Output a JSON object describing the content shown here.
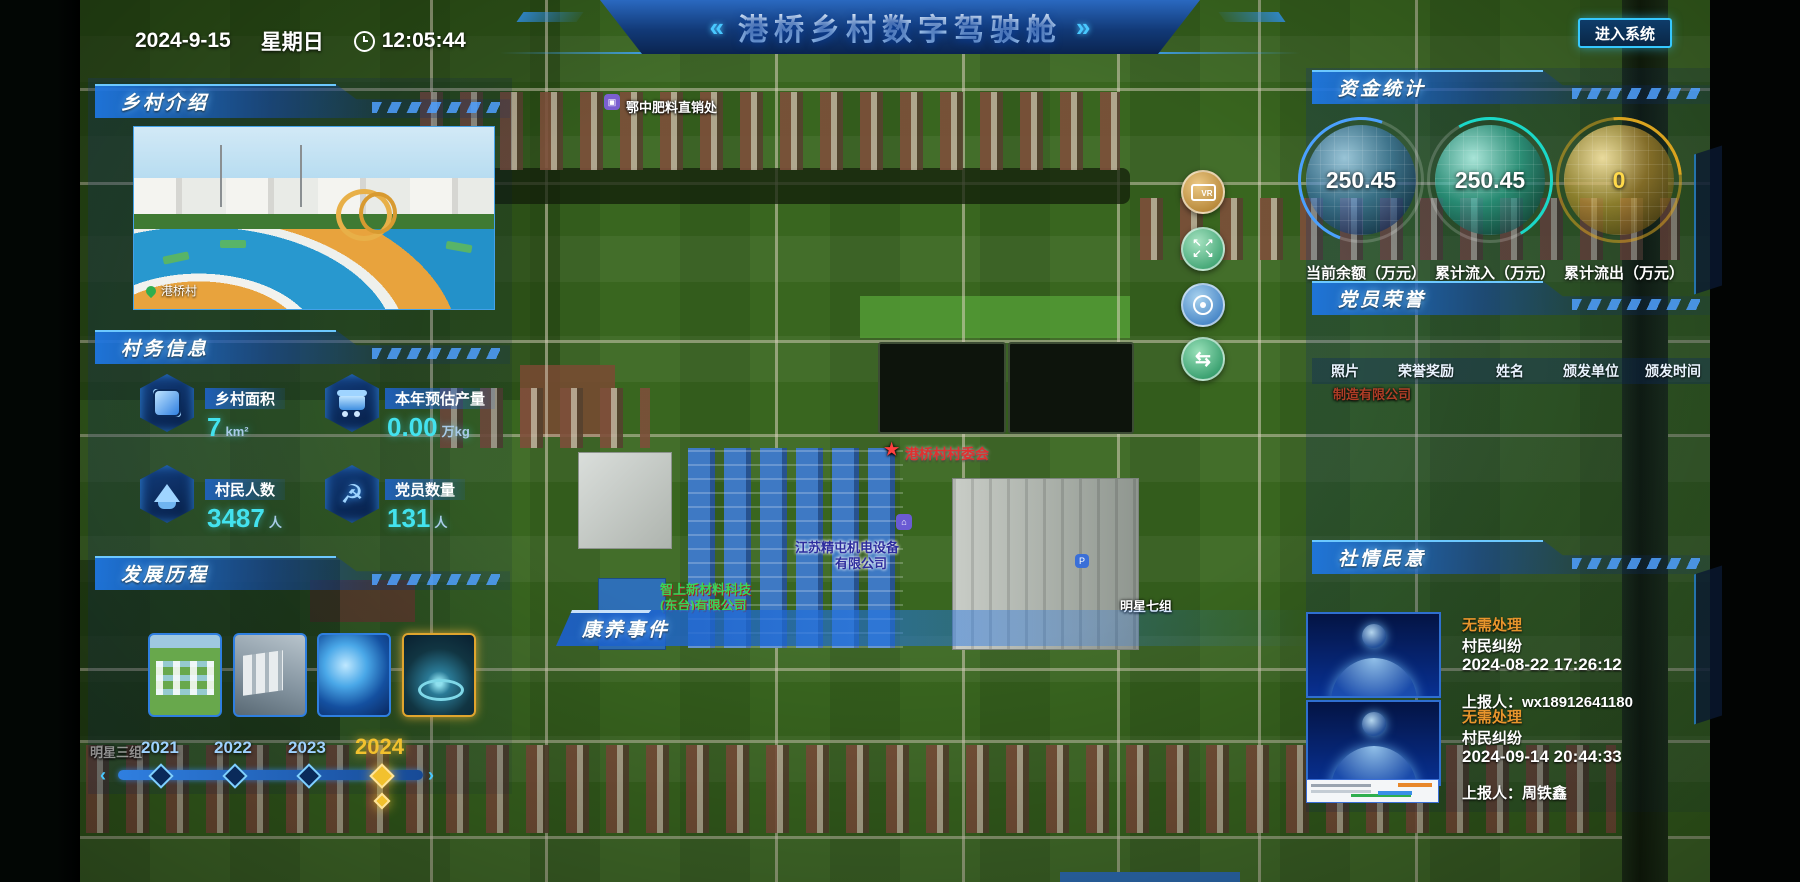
{
  "header": {
    "date": "2024-9-15",
    "weekday": "星期日",
    "time": "12:05:44",
    "chev_left": "«",
    "chev_right": "»",
    "title": "港桥乡村数字驾驶舱",
    "enter_button": "进入系统"
  },
  "colors": {
    "accent": "#35c8ff",
    "gauge_balance": "#4aa0ff",
    "gauge_inflow": "#1ad8c8",
    "gauge_outflow": "#d9a31f",
    "status_warning": "#e8952c",
    "value_cyan": "#43e2ee",
    "year_active": "#f2c12e"
  },
  "panels": {
    "village_intro": {
      "title": "乡村介绍",
      "photo_caption": "港桥村"
    },
    "village_info": {
      "title": "村务信息",
      "stats": [
        {
          "icon": "area-icon",
          "label": "乡村面积",
          "value": "7",
          "unit": "km²"
        },
        {
          "icon": "cart-icon",
          "label": "本年预估产量",
          "value": "0.00",
          "unit": "万kg"
        },
        {
          "icon": "people-icon",
          "label": "村民人数",
          "value": "3487",
          "unit": "人"
        },
        {
          "icon": "party-icon",
          "label": "党员数量",
          "value": "131",
          "unit": "人",
          "party_glyph": "☭"
        }
      ]
    },
    "development": {
      "title": "发展历程",
      "years": [
        {
          "year": "2021",
          "active": false
        },
        {
          "year": "2022",
          "active": false
        },
        {
          "year": "2023",
          "active": false
        },
        {
          "year": "2024",
          "active": true
        }
      ],
      "arrow_left": "‹",
      "arrow_right": "›"
    },
    "funds": {
      "title": "资金统计",
      "gauges": [
        {
          "value": "250.45",
          "label": "当前余额（万元）",
          "color": "#4aa0ff"
        },
        {
          "value": "250.45",
          "label": "累计流入（万元）",
          "color": "#1ad8c8"
        },
        {
          "value": "0",
          "label": "累计流出（万元）",
          "color": "#d9a31f"
        }
      ]
    },
    "party_honor": {
      "title": "党员荣誉",
      "columns": [
        "照片",
        "荣誉奖励",
        "姓名",
        "颁发单位",
        "颁发时间"
      ]
    },
    "public_opinion": {
      "title": "社情民意",
      "items": [
        {
          "status": "无需处理",
          "type": "村民纠纷",
          "time": "2024-08-22 17:26:12",
          "reporter": "上报人：wx18912641180"
        },
        {
          "status": "无需处理",
          "type": "村民纠纷",
          "time": "2024-09-14 20:44:33",
          "reporter": "上报人：周铁鑫"
        }
      ]
    }
  },
  "map": {
    "event_bar_title": "康养事件",
    "controls": [
      "vr-panorama",
      "fullscreen-expand",
      "locate-target",
      "layer-switch"
    ],
    "labels": {
      "fertilizer": "鄂中肥料直销处",
      "committee": "港桥村村委会",
      "company1_line1": "江苏精屯机电设备",
      "company1_line2": "有限公司",
      "company2_line1": "智上新材料科技",
      "company2_line2": "(东台)有限公司",
      "group7": "明星七组",
      "group3": "明星三组",
      "factory_bg": "制造有限公司",
      "parking_glyph": "P",
      "vr_glyph": "VR",
      "swap_glyph": "⇆"
    }
  }
}
